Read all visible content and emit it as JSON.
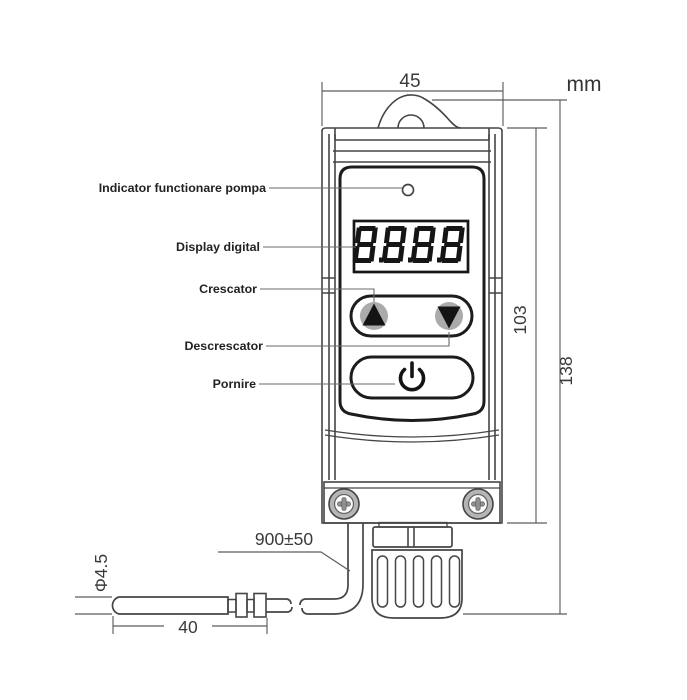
{
  "unit": "mm",
  "display": {
    "value": "8.8.8.8"
  },
  "callouts": {
    "pump_indicator": "Indicator functionare pompa",
    "digital_display": "Display digital",
    "increase": "Crescator",
    "decrease": "Descrescator",
    "power": "Pornire"
  },
  "dimensions": {
    "width_mm": "45",
    "panel_height_mm": "103",
    "total_height_mm": "138",
    "cable_length_mm": "900±50",
    "probe_diameter_mm": "Φ4.5",
    "probe_tip_length_mm": "40"
  },
  "colors": {
    "outline": "#454545",
    "bold_outline": "#1c1c1c",
    "button_fill": "#ababab",
    "leader": "#6a6a6a",
    "segment": "#161616"
  }
}
